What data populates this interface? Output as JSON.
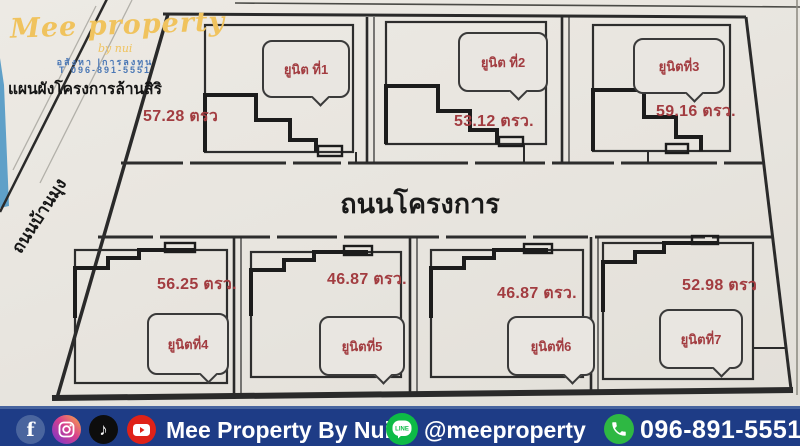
{
  "brand": {
    "logo_script": "Mee property",
    "logo_tagline": "by nui",
    "logo_line1": "อสังหา |การลงทุน",
    "logo_line2": "T 096-891-5551",
    "plan_title": "แผนผังโครงการล้านสิริ"
  },
  "plan": {
    "side_road_label": "ถนนบ้านมุง",
    "main_road_label": "ถนนโครงการ",
    "units": [
      {
        "label": "ยูนิต ที่1",
        "area": "57.28 ตรว"
      },
      {
        "label": "ยูนิต ที่2",
        "area": "53.12 ตรว."
      },
      {
        "label": "ยูนิตที่3",
        "area": "59.16 ตรว."
      },
      {
        "label": "ยูนิตที่4",
        "area": "56.25 ตรว."
      },
      {
        "label": "ยูนิตที่5",
        "area": "46.87 ตรว."
      },
      {
        "label": "ยูนิตที่6",
        "area": "46.87 ตรว."
      },
      {
        "label": "ยูนิตที่7",
        "area": "52.98 ตรว"
      }
    ]
  },
  "footer": {
    "icons": [
      "facebook-icon",
      "instagram-icon",
      "tiktok-icon",
      "youtube-icon",
      "line-icon",
      "phone-icon"
    ],
    "facebook_glyph": "f",
    "tiktok_glyph": "♪",
    "line_icon_text": "LINE",
    "brand_name": "Mee Property By Nui",
    "line_handle": "@meeproperty",
    "phone_number": "096-891-5551"
  },
  "colors": {
    "accent_red": "#a23c40",
    "bar_blue": "#1e3c86",
    "logo_yellow": "#f0c35e",
    "line_green": "#0dbb46",
    "phone_green": "#2eb843",
    "facebook_blue": "#4a659e",
    "youtube_red": "#df2218",
    "paper": "#e9e6e1",
    "ink": "#2a2a2a"
  }
}
